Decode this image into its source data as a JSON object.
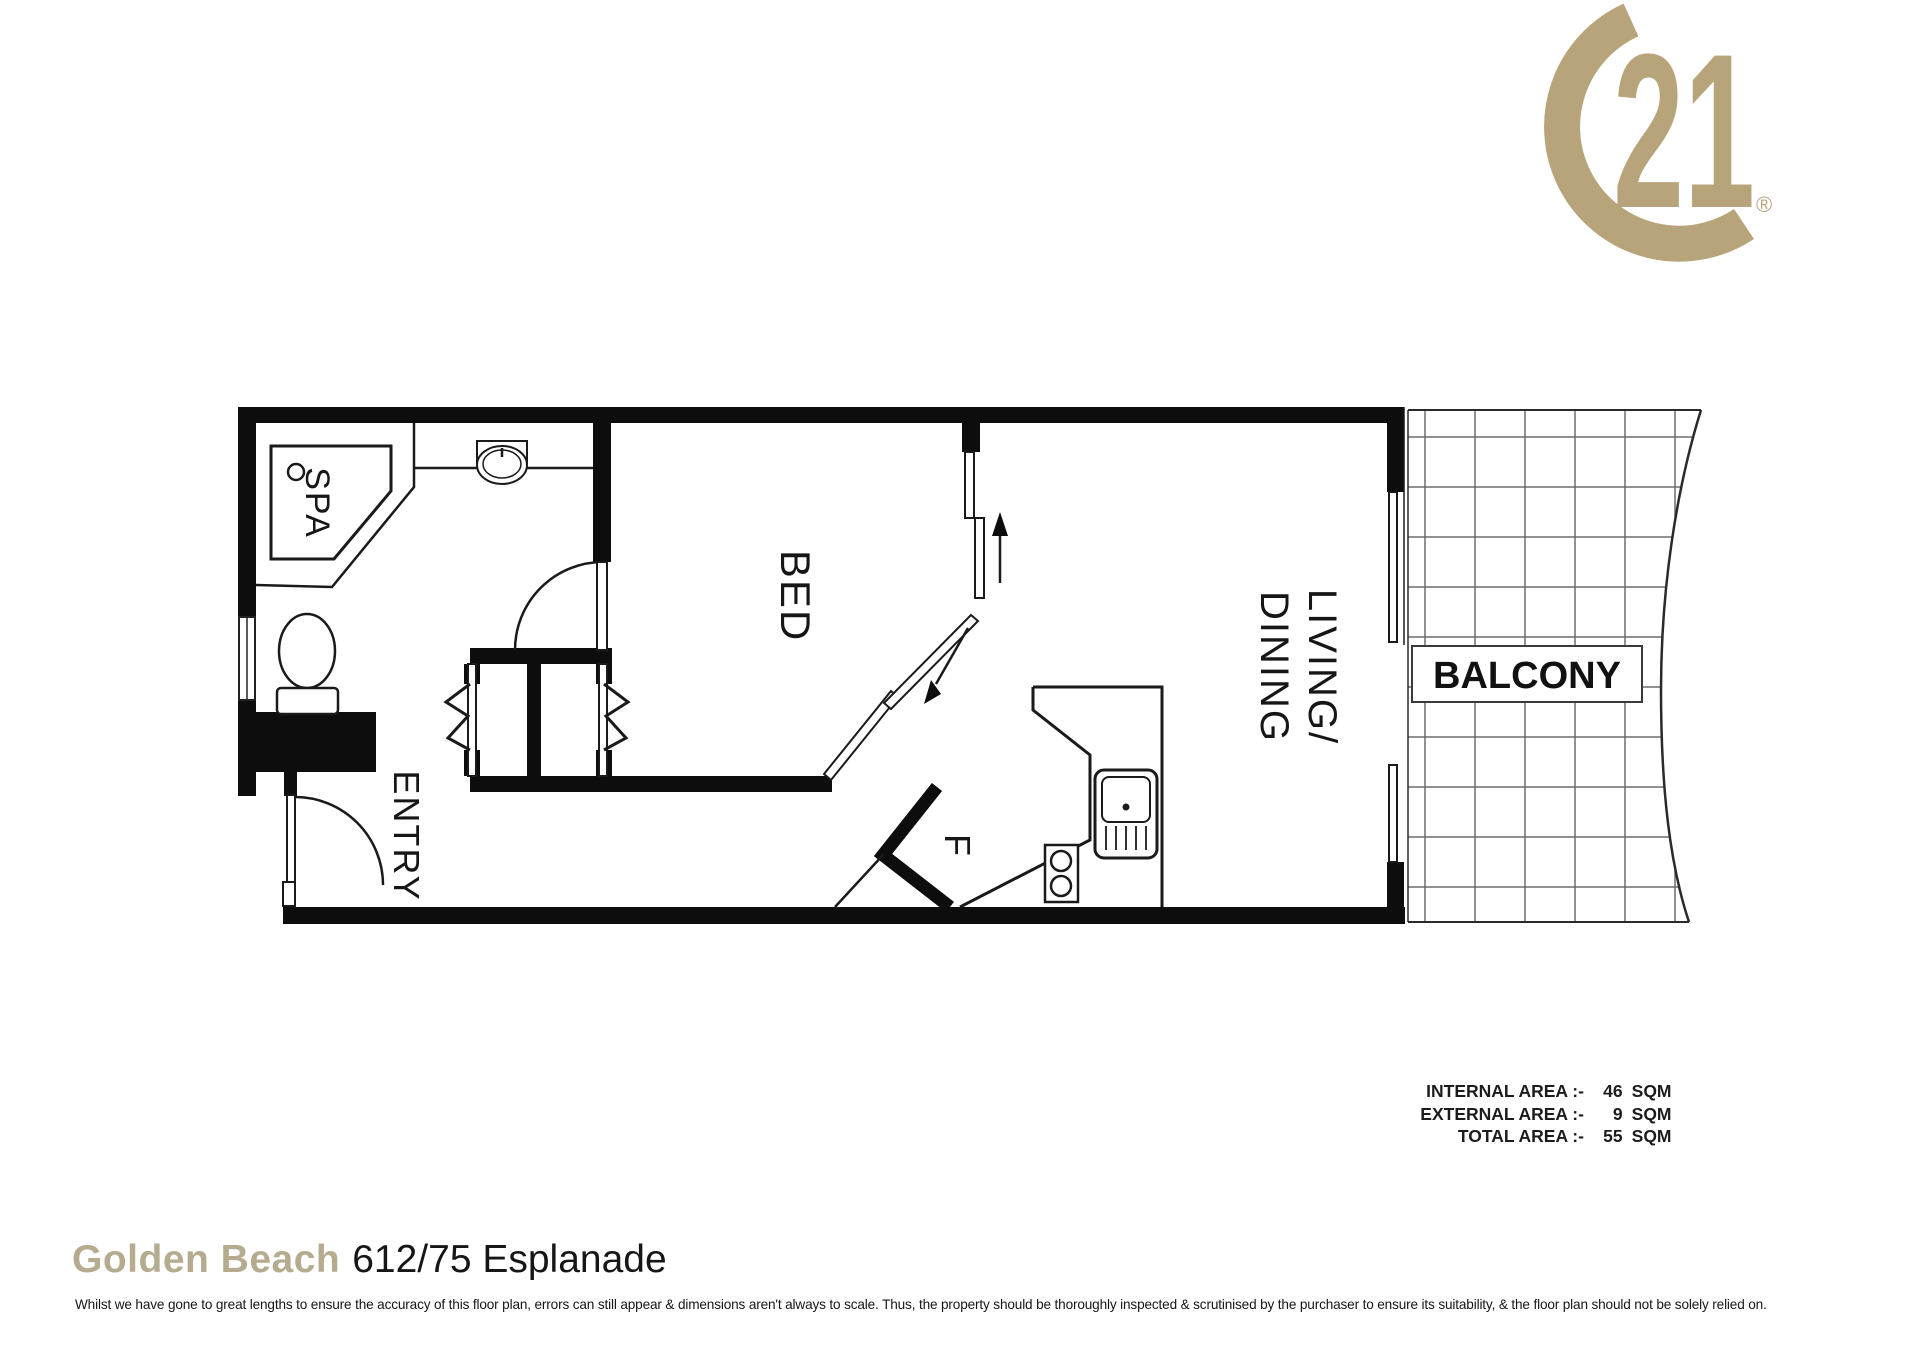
{
  "logo": {
    "number": "21",
    "registered": "®",
    "color": "#b8a47a"
  },
  "colors": {
    "logo_gold": "#b8a47a",
    "title_gold": "#b5ab8f",
    "line_black": "#111111",
    "grid_gray": "#6d6d6d"
  },
  "floorplan": {
    "labels": {
      "spa": "SPA",
      "entry": "ENTRY",
      "bed": "BED",
      "living_line1": "LIVING/",
      "living_line2": "DINING",
      "fridge": "F",
      "balcony": "BALCONY"
    }
  },
  "areas": {
    "rows": [
      {
        "label": "INTERNAL AREA :-",
        "value": "46",
        "unit": "SQM"
      },
      {
        "label": "EXTERNAL AREA :-",
        "value": "9",
        "unit": "SQM"
      },
      {
        "label": "TOTAL AREA :-",
        "value": "55",
        "unit": "SQM"
      }
    ]
  },
  "footer": {
    "suburb": "Golden Beach",
    "address": "612/75 Esplanade",
    "disclaimer": "Whilst we have gone to great lengths to ensure the accuracy of this floor plan, errors can still appear & dimensions aren't always to scale. Thus, the property should be thoroughly inspected & scrutinised by the purchaser to ensure its suitability, & the floor plan should not be solely relied on."
  }
}
